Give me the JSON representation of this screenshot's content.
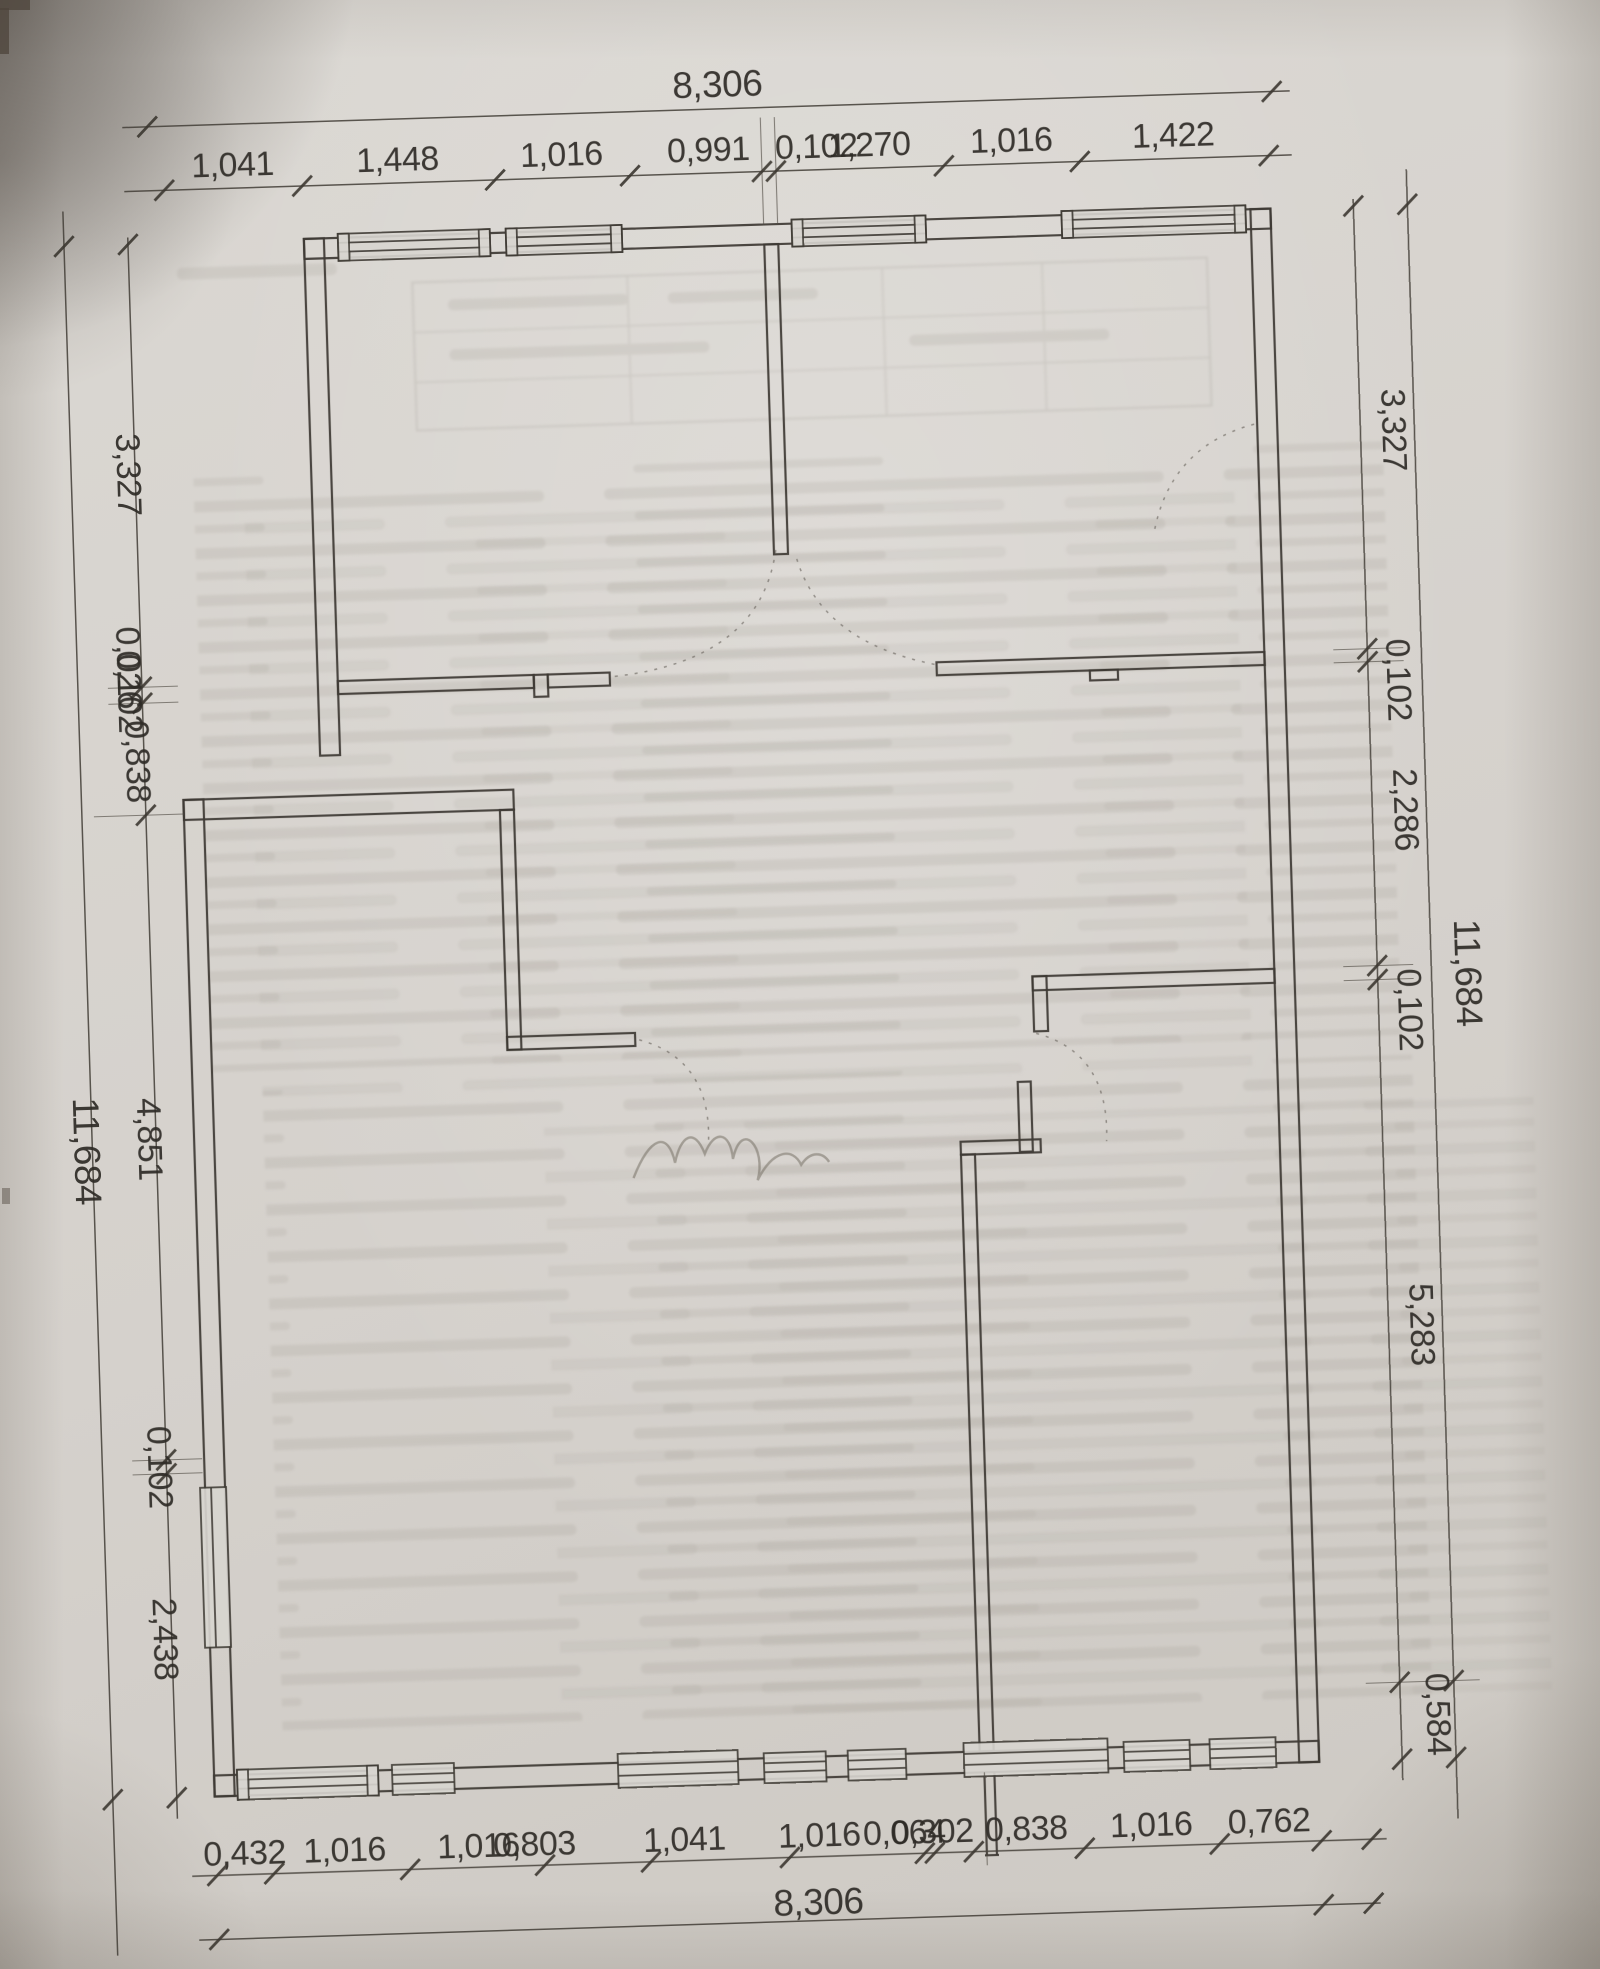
{
  "drawing": {
    "dims": {
      "top": {
        "total": "8,306",
        "segments": [
          "1,041",
          "1,448",
          "1,016",
          "0,991",
          "0,102",
          "1,270",
          "1,016",
          "1,422"
        ]
      },
      "bottom": {
        "total": "8,306",
        "segments": [
          "0,432",
          "1,016",
          "1,016",
          "0,803",
          "1,041",
          "1,016",
          "0,064",
          "0,302",
          "0,838",
          "1,016",
          "0,762"
        ]
      },
      "left": {
        "total": "11,684",
        "segments": [
          "3,327",
          "0,026",
          "0,102",
          "0,838",
          "4,851",
          "0,102",
          "2,438"
        ]
      },
      "right": {
        "total": "11,684",
        "segments": [
          "3,327",
          "0,102",
          "2,286",
          "0,102",
          "5,283",
          "0,584"
        ]
      }
    }
  }
}
